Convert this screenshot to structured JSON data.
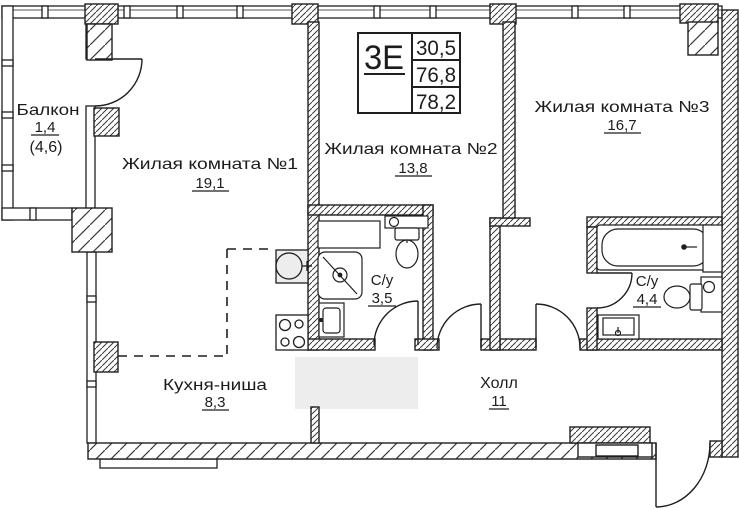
{
  "plan": {
    "type_label": "3Е",
    "stats": [
      "30,5",
      "76,8",
      "78,2"
    ],
    "rooms": {
      "balcony": {
        "name": "Балкон",
        "area": "1,4",
        "area_alt": "(4,6)"
      },
      "living1": {
        "name": "Жилая комната №1",
        "area": "19,1"
      },
      "living2": {
        "name": "Жилая комната №2",
        "area": "13,8"
      },
      "living3": {
        "name": "Жилая комната №3",
        "area": "16,7"
      },
      "bath1": {
        "name": "С/у",
        "area": "3,5"
      },
      "bath2": {
        "name": "С/у",
        "area": "4,4"
      },
      "kitchen": {
        "name": "Кухня-ниша",
        "area": "8,3"
      },
      "hall": {
        "name": "Холл",
        "area": "11"
      }
    },
    "colors": {
      "line": "#1f1f1f",
      "background": "#ffffff",
      "zone_highlight": "#ededed"
    }
  }
}
